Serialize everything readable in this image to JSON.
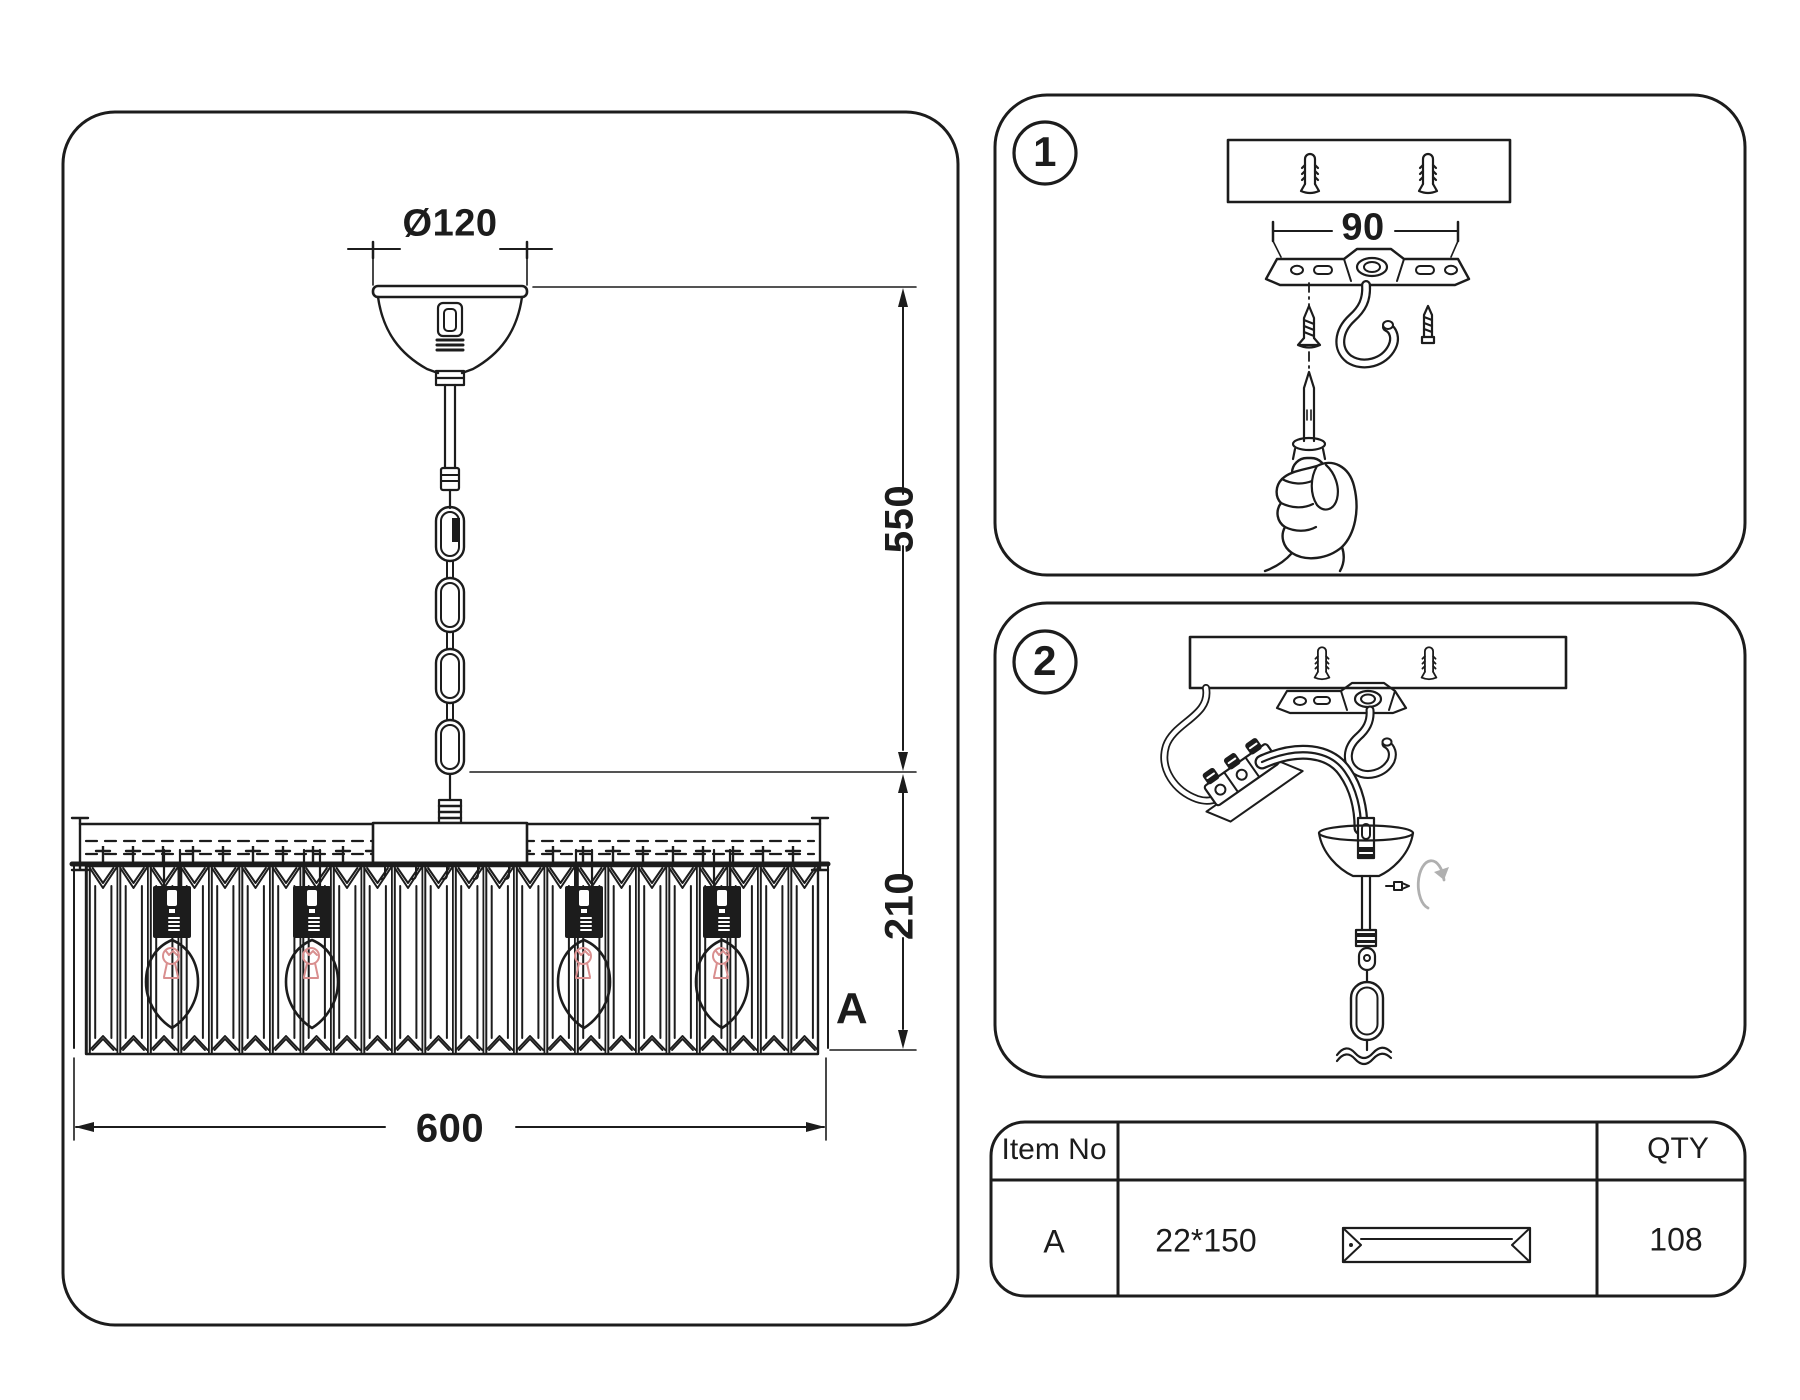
{
  "left_panel": {
    "dims": {
      "canopy_diameter": "Ø120",
      "hang_height": "550",
      "shade_height": "210",
      "shade_width": "600"
    },
    "crystal_label": "A"
  },
  "steps": [
    {
      "number": "1",
      "plate_width": "90"
    },
    {
      "number": "2"
    }
  ],
  "parts_table": {
    "header": {
      "item_no": "Item No",
      "qty": "QTY"
    },
    "rows": [
      {
        "item_no": "A",
        "size": "22*150",
        "qty": "108"
      }
    ]
  },
  "figures": {
    "left": [
      "canopy",
      "suspension-chain",
      "crystal-shade",
      "candle-bulbs",
      "dimension-lines"
    ],
    "step1": [
      "ceiling-board",
      "wall-plugs",
      "mounting-plate",
      "ceiling-hook",
      "wood-screws",
      "hand-with-awl"
    ],
    "step2": [
      "ceiling-board",
      "mounting-plate",
      "ceiling-hook",
      "wires",
      "terminal-block",
      "canopy-assembly",
      "rotation-arrow",
      "chain-link"
    ],
    "table": [
      "crystal-prism-icon"
    ]
  },
  "colors": {
    "line": "#1c1c1c",
    "background": "#ffffff",
    "filament": "#d98f8f",
    "rotation_arrow": "#b0b0b0"
  }
}
